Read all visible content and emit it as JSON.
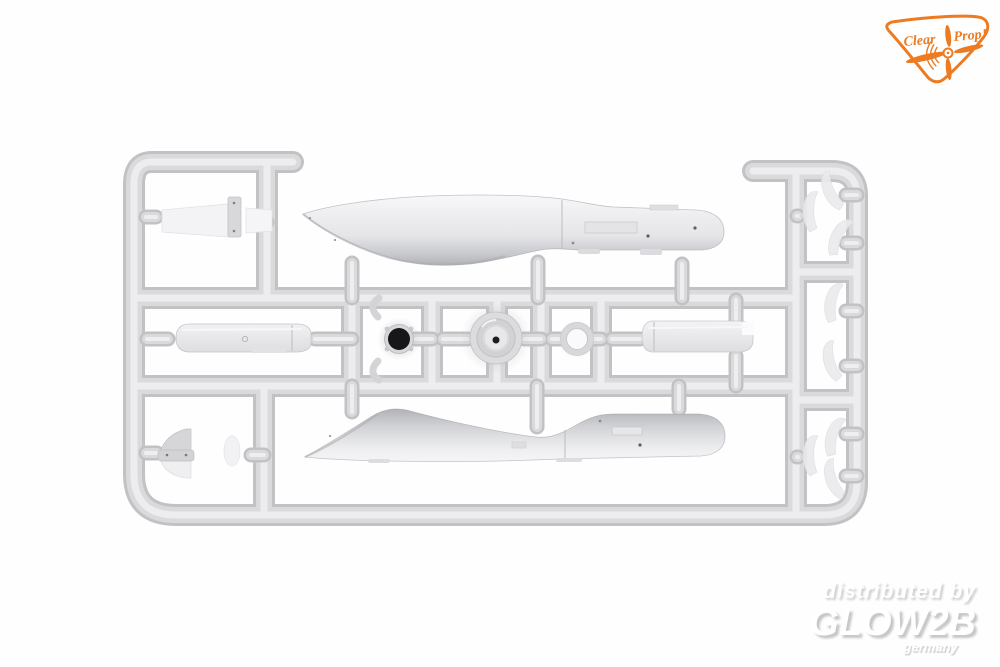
{
  "image": {
    "type": "product-photo",
    "subject": "light gray injection-molded model aircraft kit sprue on white background",
    "background_color": "#fefefe",
    "plastic_color": "#d7d7da"
  },
  "logo": {
    "brand": "Clear Prop!",
    "text_left": "Clear",
    "text_right": "Prop!",
    "accent_color": "#ec7b22",
    "shape": "rounded plectrum badge",
    "icon": "propeller-icon"
  },
  "watermark": {
    "line1": "distributed by",
    "line2": "GLOW2B",
    "line3": "germany",
    "text_color": "#ffffff",
    "shadow_color": "#c9c9c9"
  },
  "sprue": {
    "parts_visible": [
      "upper fuselage half",
      "lower fuselage half",
      "engine cowling",
      "cowling ring with open front",
      "wheel ring",
      "left float section",
      "right float section",
      "horizontal stabilizer",
      "tail cone",
      "propeller blades",
      "exhaust stubs"
    ]
  }
}
